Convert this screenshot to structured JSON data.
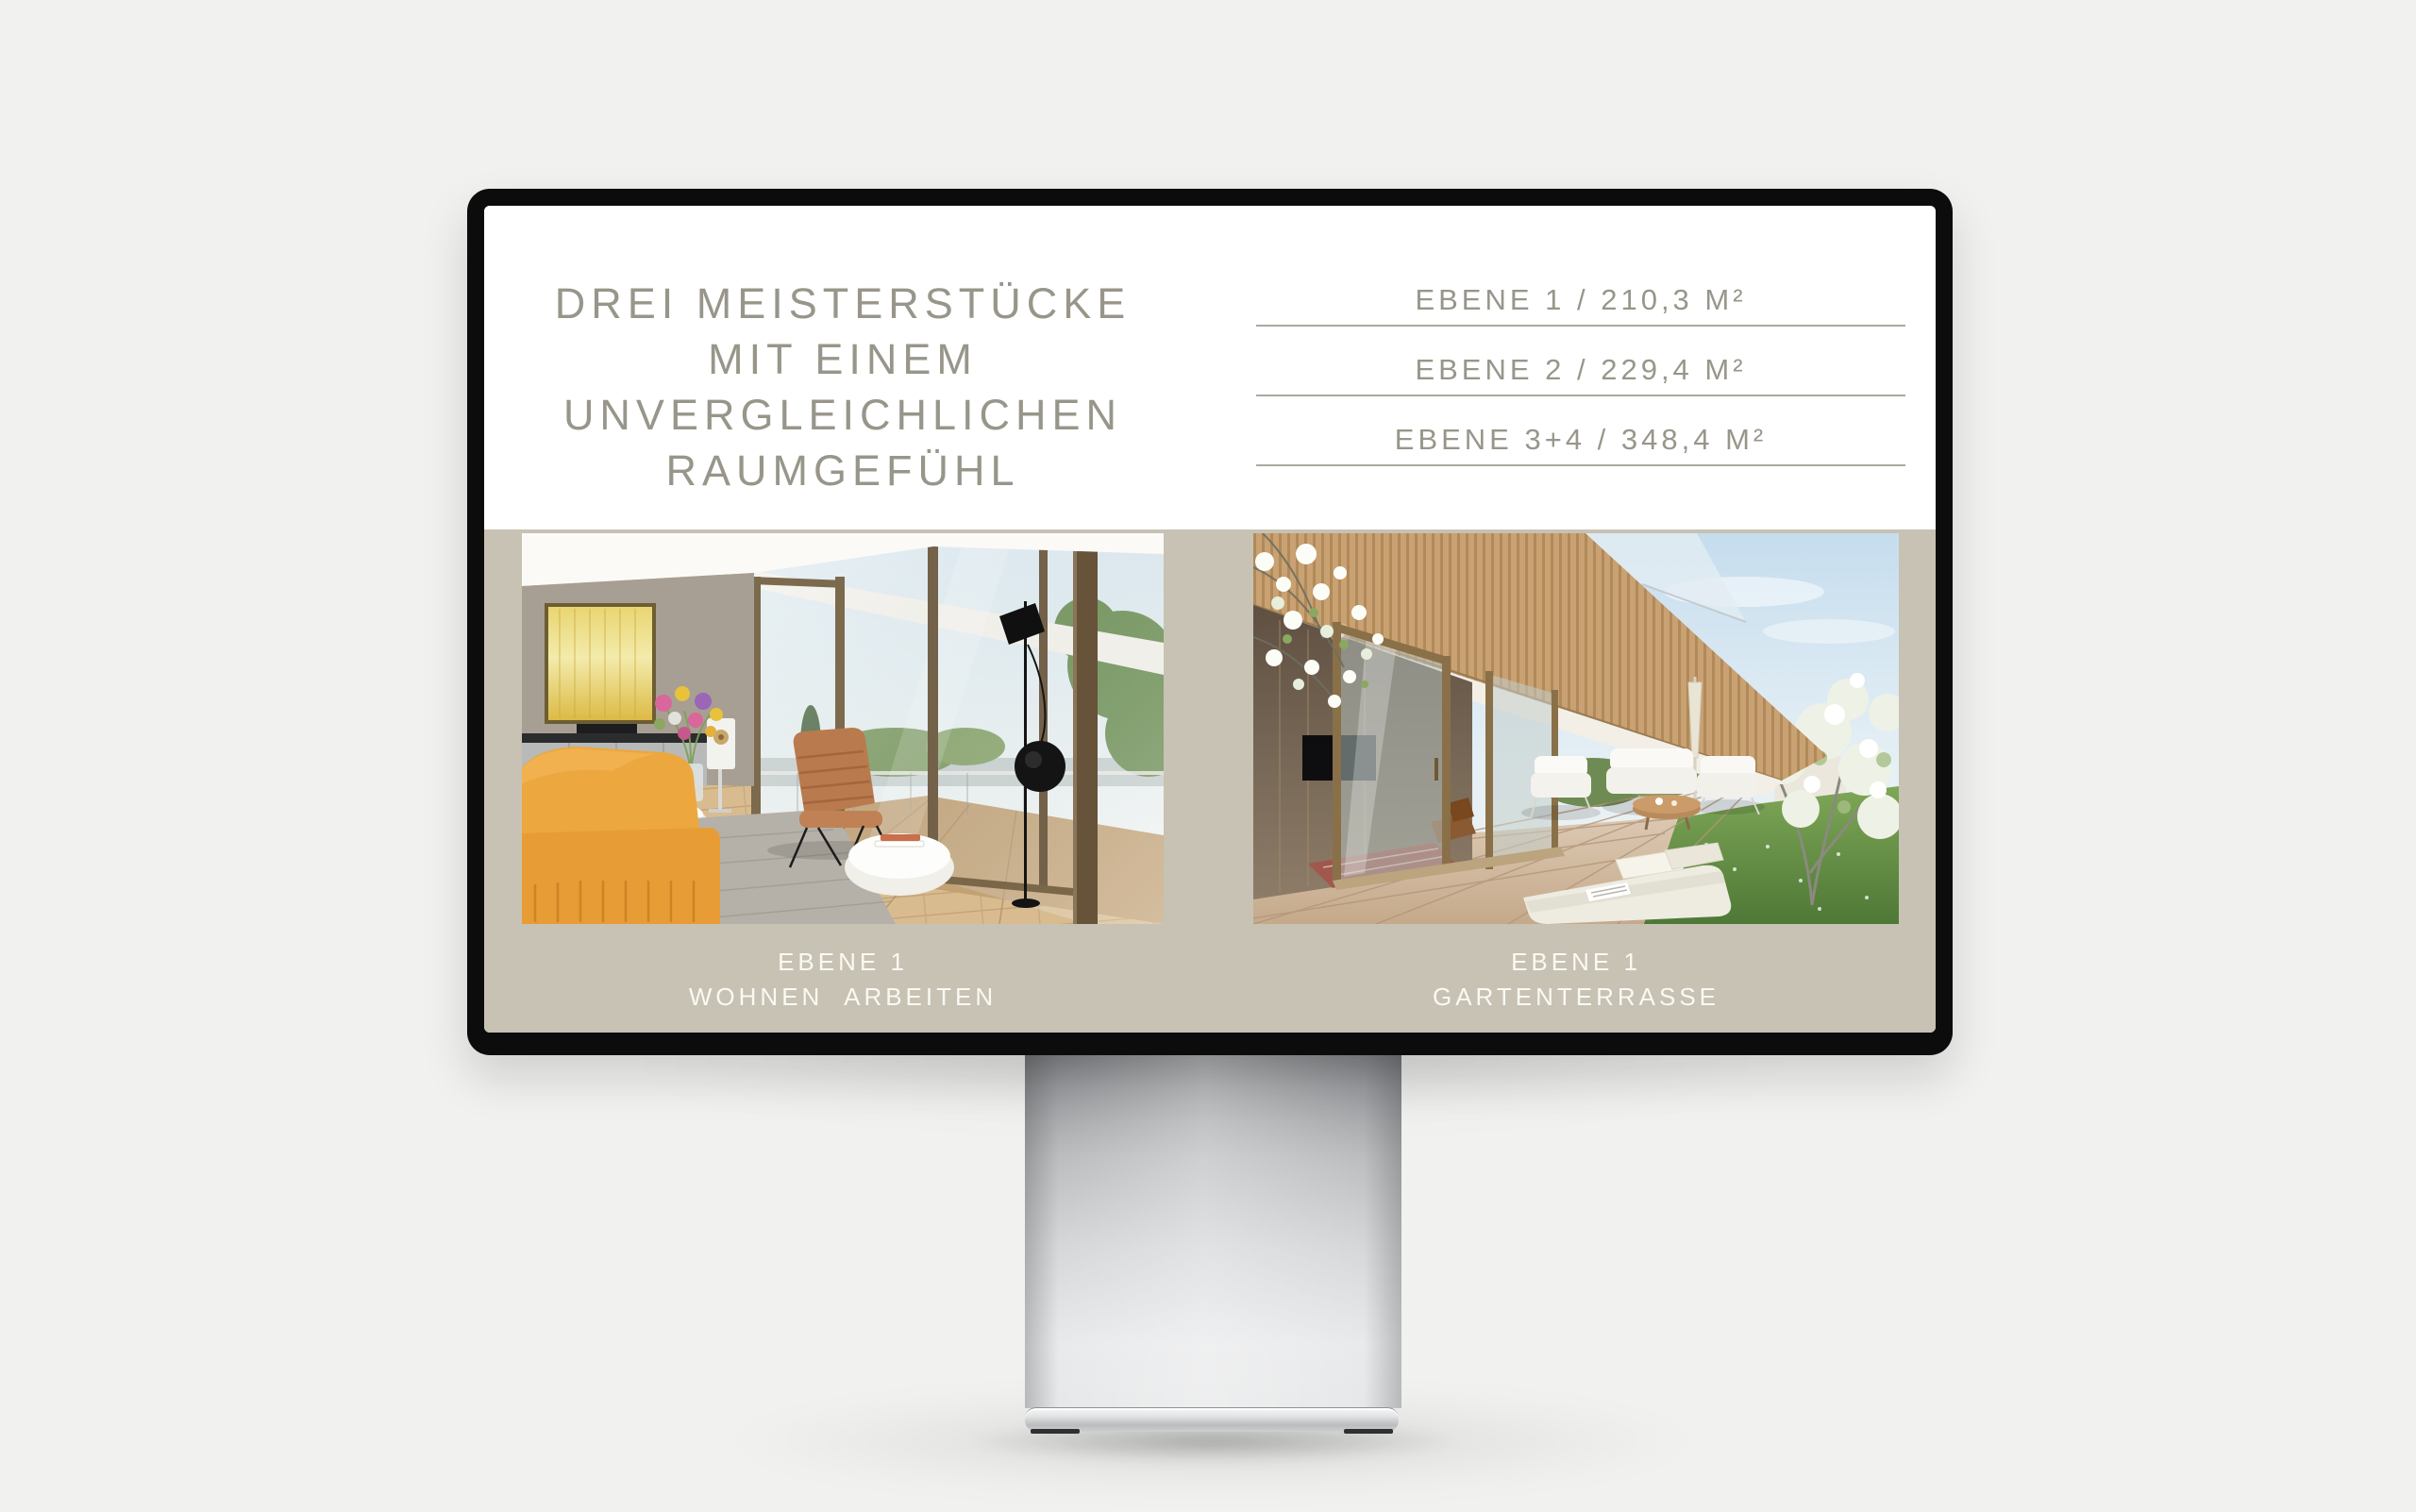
{
  "slide": {
    "headline_lines": [
      "DREI MEISTERSTÜCKE",
      "MIT EINEM",
      "UNVERGLEICHLICHEN",
      "RAUMGEFÜHL"
    ],
    "levels": [
      "EBENE 1 / 210,3 M²",
      "EBENE 2 / 229,4 M²",
      "EBENE 3+4 / 348,4 M²"
    ],
    "figures": [
      {
        "caption": [
          "EBENE 1",
          "WOHNEN ARBEITEN"
        ]
      },
      {
        "caption": [
          "EBENE 1",
          "GARTENTERRASSE"
        ]
      }
    ],
    "colors": {
      "headline_text": "#98968a",
      "level_text": "#98968a",
      "divider": "#aaa99c",
      "band_background": "#c7c2b3",
      "caption_text": "#faf9f3",
      "screen_background": "#ffffff",
      "bezel": "#0c0c0c",
      "backdrop": "#f1f1ef"
    }
  }
}
